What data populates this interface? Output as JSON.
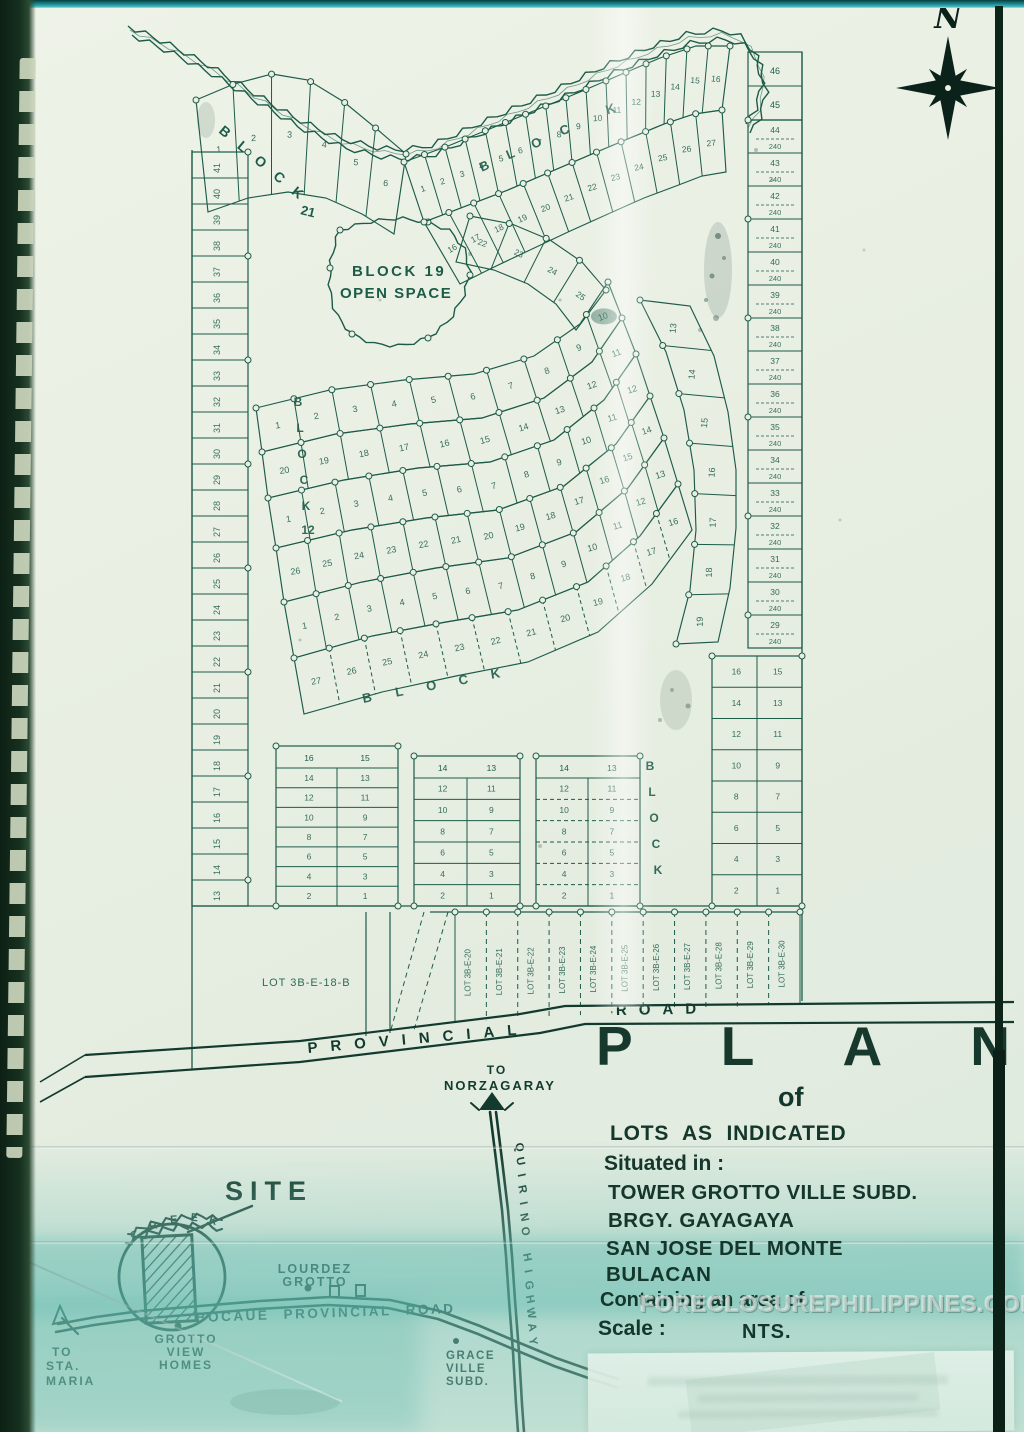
{
  "page": {
    "ink": "#1d5b49",
    "ink_dark": "#123a2e",
    "paper": "#e9efe3",
    "aqua": "#9fd2c6"
  },
  "compass": {
    "north_label": "N"
  },
  "plat": {
    "block21_letters": "B L O C K",
    "block21_number": "21",
    "block19_line1": "BLOCK 19",
    "block19_line2": "OPEN SPACE",
    "street_block_word": "BLOCK",
    "big_lot_label": "LOT 3B-E-18-B",
    "area_value": "240",
    "shaded_lot_number": "10",
    "right_top_numbers": [
      "46",
      "45"
    ],
    "right_strip_numbers": [
      "44",
      "43",
      "42",
      "41",
      "40",
      "39",
      "38",
      "37",
      "36",
      "35",
      "34",
      "33",
      "32",
      "31",
      "30",
      "29"
    ],
    "left_strip_numbers": [
      "41",
      "40",
      "39",
      "38",
      "37",
      "36",
      "35",
      "34",
      "33",
      "32",
      "31",
      "30",
      "29",
      "28",
      "27",
      "26",
      "25",
      "24",
      "23",
      "22",
      "21",
      "20",
      "19",
      "18",
      "17",
      "16",
      "15",
      "14",
      "13"
    ],
    "top_fan_numbers": [
      "1",
      "2",
      "3",
      "4",
      "5",
      "6",
      "7",
      "8",
      "9",
      "10",
      "11",
      "12",
      "13",
      "14",
      "15",
      "16"
    ],
    "fan2_numbers": [
      "16",
      "17",
      "18",
      "19",
      "20",
      "21",
      "22",
      "23",
      "24",
      "25",
      "26",
      "27"
    ],
    "ne_band_numbers": [
      "22",
      "23",
      "24",
      "25"
    ],
    "band1_numbers": [
      "1",
      "2",
      "3",
      "4",
      "5",
      "6",
      "7",
      "8",
      "9",
      "10"
    ],
    "band2_numbers": [
      "20",
      "19",
      "18",
      "17",
      "16",
      "15",
      "14",
      "13",
      "12",
      "11"
    ],
    "band3_numbers": [
      "1",
      "2",
      "3",
      "4",
      "5",
      "6",
      "7",
      "8",
      "9",
      "10",
      "11",
      "12"
    ],
    "band4_numbers": [
      "26",
      "25",
      "24",
      "23",
      "22",
      "21",
      "20",
      "19",
      "18",
      "17",
      "16",
      "15",
      "14"
    ],
    "band5_numbers": [
      "1",
      "2",
      "3",
      "4",
      "5",
      "6",
      "7",
      "8",
      "9",
      "10",
      "11",
      "12",
      "13"
    ],
    "band6_numbers": [
      "27",
      "26",
      "25",
      "24",
      "23",
      "22",
      "21",
      "20",
      "19",
      "18",
      "17",
      "16"
    ],
    "right_band_numbers": [
      "13",
      "14",
      "15",
      "16",
      "17",
      "18",
      "19"
    ],
    "grid1_top": [
      "16",
      "15"
    ],
    "grid1_pairs": [
      [
        "14",
        "13"
      ],
      [
        "12",
        "11"
      ],
      [
        "10",
        "9"
      ],
      [
        "8",
        "7"
      ],
      [
        "6",
        "5"
      ],
      [
        "4",
        "3"
      ],
      [
        "2",
        "1"
      ]
    ],
    "grid2_top": [
      "14",
      "13"
    ],
    "grid2_pairs": [
      [
        "12",
        "11"
      ],
      [
        "10",
        "9"
      ],
      [
        "8",
        "7"
      ],
      [
        "6",
        "5"
      ],
      [
        "4",
        "3"
      ],
      [
        "2",
        "1"
      ]
    ],
    "grid3_top": [
      "14",
      "13"
    ],
    "grid3_pairs": [
      [
        "12",
        "11"
      ],
      [
        "10",
        "9"
      ],
      [
        "8",
        "7"
      ],
      [
        "6",
        "5"
      ],
      [
        "4",
        "3"
      ],
      [
        "2",
        "1"
      ]
    ],
    "grid4_pairs": [
      [
        "16",
        "15"
      ],
      [
        "14",
        "13"
      ],
      [
        "12",
        "11"
      ],
      [
        "10",
        "9"
      ],
      [
        "8",
        "7"
      ],
      [
        "6",
        "5"
      ],
      [
        "4",
        "3"
      ],
      [
        "2",
        "1"
      ]
    ],
    "lot_strip_labels": [
      "LOT 3B-E-20",
      "LOT 3B-E-21",
      "LOT 3B-E-22",
      "LOT 3B-E-23",
      "LOT 3B-E-24",
      "LOT 3B-E-25",
      "LOT 3B-E-26",
      "LOT 3B-E-27",
      "LOT 3B-E-28",
      "LOT 3B-E-29",
      "LOT 3B-E-30"
    ]
  },
  "road": {
    "left": "PROVINCIAL",
    "right": "ROAD"
  },
  "title_block": {
    "title_letters": [
      "P",
      "L",
      "A",
      "N"
    ],
    "of": "of",
    "line1": "LOTS AS INDICATED",
    "line2": "Situated in :",
    "line3": "TOWER GROTTO VILLE SUBD.",
    "line4": "BRGY. GAYAGAYA",
    "line5": "SAN JOSE DEL MONTE",
    "line6": "BULACAN",
    "line7": "Containing an area of :",
    "scale_label": "Scale :",
    "scale_value": "NTS."
  },
  "vicinity": {
    "site": "SITE",
    "creek": "CREEK",
    "lourdez_line1": "LOURDEZ",
    "lourdez_line2": "GROTTO",
    "bocaue_road": "BOCAUE PROVINCIAL ROAD",
    "grotto_view_line1": "GROTTO",
    "grotto_view_line2": "VIEW",
    "grotto_view_line3": "HOMES",
    "sta_maria_line1": "TO",
    "sta_maria_line2": "STA.",
    "sta_maria_line3": "MARIA",
    "norzagaray_line1": "TO",
    "norzagaray_line2": "NORZAGARAY",
    "quirino": "QUIRINO HIGHWAY",
    "grace_line1": "GRACE",
    "grace_line2": "VILLE",
    "grace_line3": "SUBD."
  },
  "watermark": "FORECLOSUREPHILIPPINES.COM"
}
